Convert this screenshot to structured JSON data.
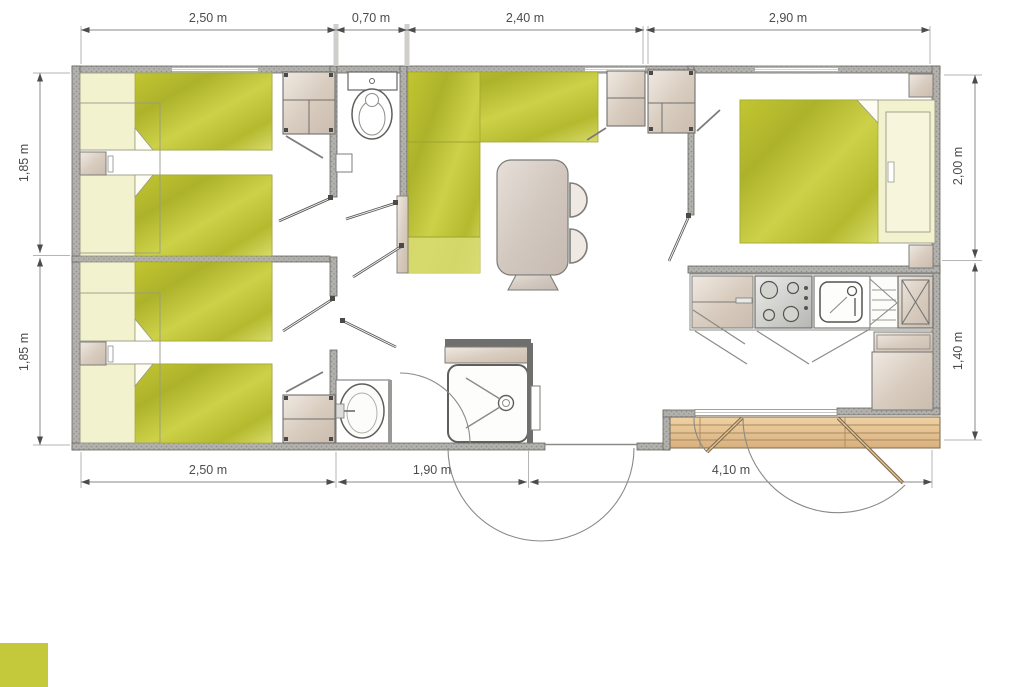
{
  "dimensions": {
    "top": [
      "2,50 m",
      "0,70 m",
      "2,40 m",
      "2,90 m"
    ],
    "left": [
      "1,85 m",
      "1,85 m"
    ],
    "right": [
      "2,00 m",
      "1,40 m"
    ],
    "bottom": [
      "2,50 m",
      "1,90 m",
      "4,10 m"
    ]
  },
  "colors": {
    "accent_yellow": "#c6ca35",
    "pale_linen": "#f3f2cf",
    "wall_gray": "#b2b1ae",
    "furniture_beige": "#d9cdc0",
    "deck_wood": "#e5c493",
    "dimension_text": "#4c4c4c",
    "logo_swatch": "#c4c93b"
  }
}
